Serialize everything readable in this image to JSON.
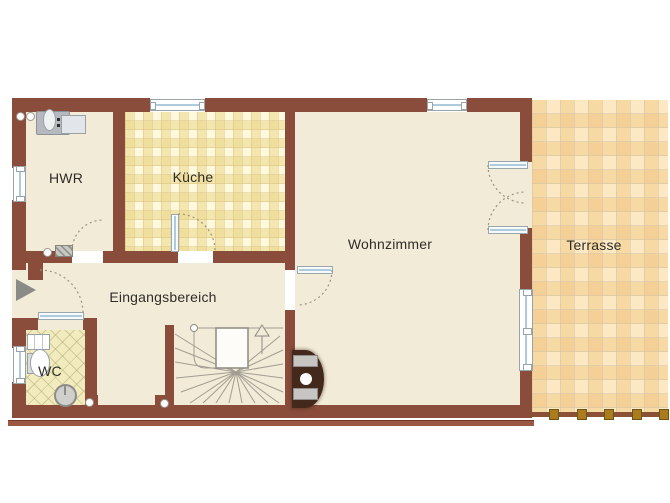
{
  "plan": {
    "type": "residential floor plan"
  },
  "rooms": {
    "hwr": {
      "label": "HWR"
    },
    "kueche": {
      "label": "Küche"
    },
    "wohnzimmer": {
      "label": "Wohnzimmer"
    },
    "eingangsbereich": {
      "label": "Eingangsbereich"
    },
    "wc": {
      "label": "WC"
    },
    "terrasse": {
      "label": "Terrasse"
    }
  },
  "icons": {
    "entrance_arrow": "right-pointing entrance arrow",
    "stairs_up_arrow": "stairs-direction-up arrow"
  },
  "colors": {
    "wall": "#8b4d3b",
    "wall_trim": "#9c5743",
    "floor": "#f2ebd7",
    "kitchen_tile": "#f3e6ae",
    "terrace_tile": "#f7d9a4",
    "wc_tile": "#f1ebbd",
    "window_glass": "#aecbdb",
    "fence_post": "#a97d1e",
    "label_text": "#2f2d28",
    "background": "#ffffff"
  }
}
